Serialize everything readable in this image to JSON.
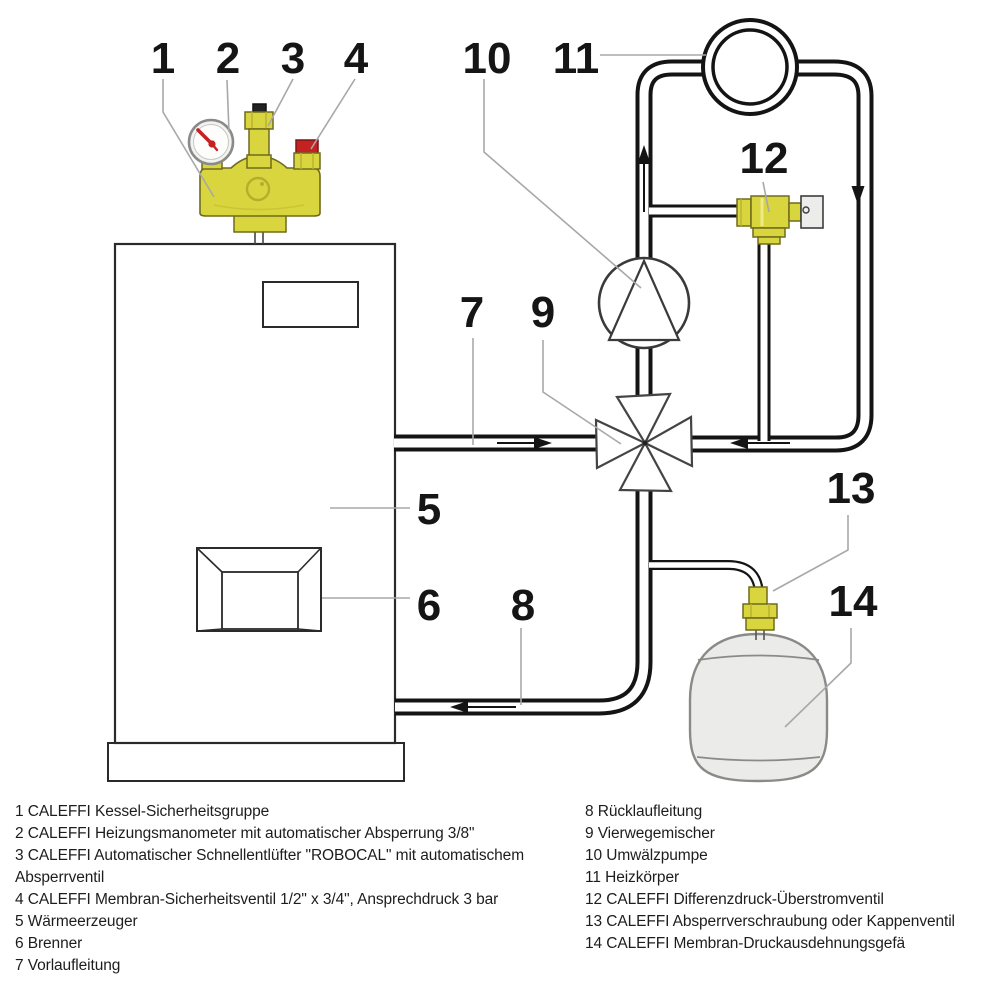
{
  "colors": {
    "brass": "#d9d53f",
    "brass_dark": "#6f6b1d",
    "red_cap": "#c42222",
    "pipe_line": "#141414",
    "leader_gray": "#a8a8a8",
    "vessel_fill": "#ebebe9",
    "text": "#1d1d1d"
  },
  "diagram": {
    "callouts": {
      "c1": "1",
      "c2": "2",
      "c3": "3",
      "c4": "4",
      "c5": "5",
      "c6": "6",
      "c7": "7",
      "c8": "8",
      "c9": "9",
      "c10": "10",
      "c11": "11",
      "c12": "12",
      "c13": "13",
      "c14": "14"
    },
    "components": {
      "safety_group": "Kessel-Sicherheitsgruppe",
      "manometer": "Heizungsmanometer",
      "air_vent": "Schnellentlüfter ROBOCAL",
      "safety_valve": "Membran-Sicherheitsventil",
      "boiler": "Wärmeerzeuger",
      "burner": "Brenner",
      "supply": "Vorlaufleitung",
      "return": "Rücklaufleitung",
      "mixer": "Vierwegemischer",
      "pump": "Umwälzpumpe",
      "radiator": "Heizkörper",
      "overflow_valve": "Differenzdruck-Überstromventil",
      "cap_valve": "Absperrverschraubung oder Kappenventil",
      "expansion_vessel": "Membran-Druckausdehnungsgefä"
    }
  },
  "legend": {
    "left_lines": [
      "1 CALEFFI Kessel-Sicherheitsgruppe",
      "2 CALEFFI Heizungsmanometer mit automatischer Absperrung 3/8\"",
      "3 CALEFFI Automatischer Schnellentlüfter \"ROBOCAL\" mit automatischem",
      "Absperrventil",
      "4 CALEFFI Membran-Sicherheitsventil 1/2\" x 3/4\", Ansprechdruck 3 bar",
      "5 Wärmeerzeuger",
      "6 Brenner",
      "7 Vorlaufleitung"
    ],
    "right_lines": [
      "8 Rücklaufleitung",
      "9 Vierwegemischer",
      "10 Umwälzpumpe",
      "11 Heizkörper",
      "12 CALEFFI Differenzdruck-Überstromventil",
      "13 CALEFFI Absperrverschraubung oder Kappenventil",
      "14 CALEFFI Membran-Druckausdehnungsgefä"
    ]
  }
}
